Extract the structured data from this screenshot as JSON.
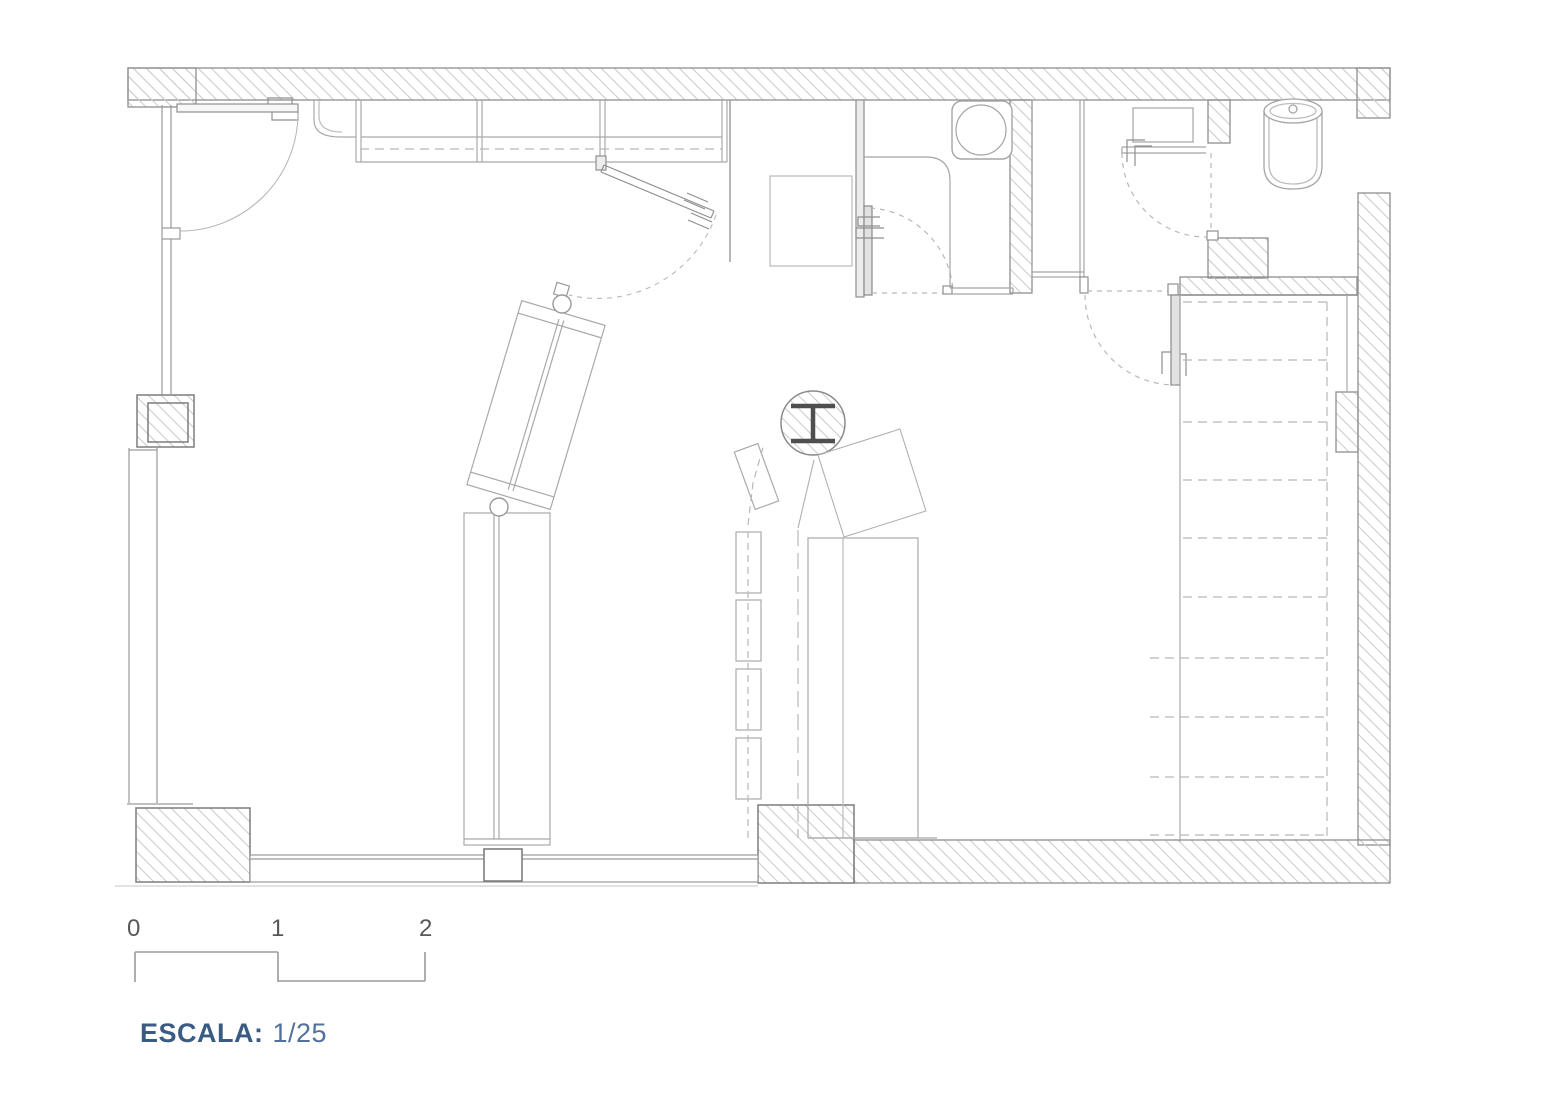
{
  "title": {
    "scale_label": "ESCALA:",
    "scale_value": "1/25"
  },
  "scale_bar": {
    "ticks": [
      "0",
      "1",
      "2"
    ]
  },
  "colors": {
    "wall_line": "#8f8f8f",
    "hatch_line": "#cdcdcd",
    "furniture_line": "#adadad",
    "dash_line": "#b8b8b8",
    "steel_column": "#4f4f4f",
    "caption_blue_bold": "#3b5c82",
    "caption_blue_light": "#52709b",
    "tick_text": "#585858"
  }
}
